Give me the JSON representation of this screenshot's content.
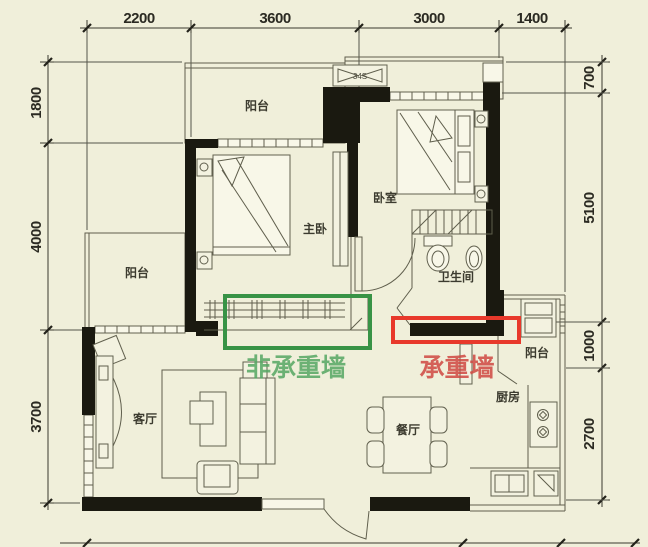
{
  "rooms": {
    "balcony_top": "阳台",
    "balcony_left": "阳台",
    "balcony_right": "阳台",
    "master_bedroom": "主卧",
    "bedroom": "卧室",
    "bathroom": "卫生间",
    "living_room": "客厅",
    "dining_room": "餐厅",
    "kitchen": "厨房"
  },
  "ac_unit_label": "34S",
  "dimensions": {
    "top": [
      "2200",
      "3600",
      "3000",
      "1400"
    ],
    "left": [
      "1800",
      "4000",
      "3700"
    ],
    "right": [
      "700",
      "5100",
      "1000",
      "2700"
    ]
  },
  "annotations": {
    "non_load_bearing": {
      "label": "非承重墙",
      "box_color": "#389346",
      "text_color": "#55a763"
    },
    "load_bearing": {
      "label": "承重墙",
      "box_color": "#e8392b",
      "text_color": "#d04842"
    }
  }
}
